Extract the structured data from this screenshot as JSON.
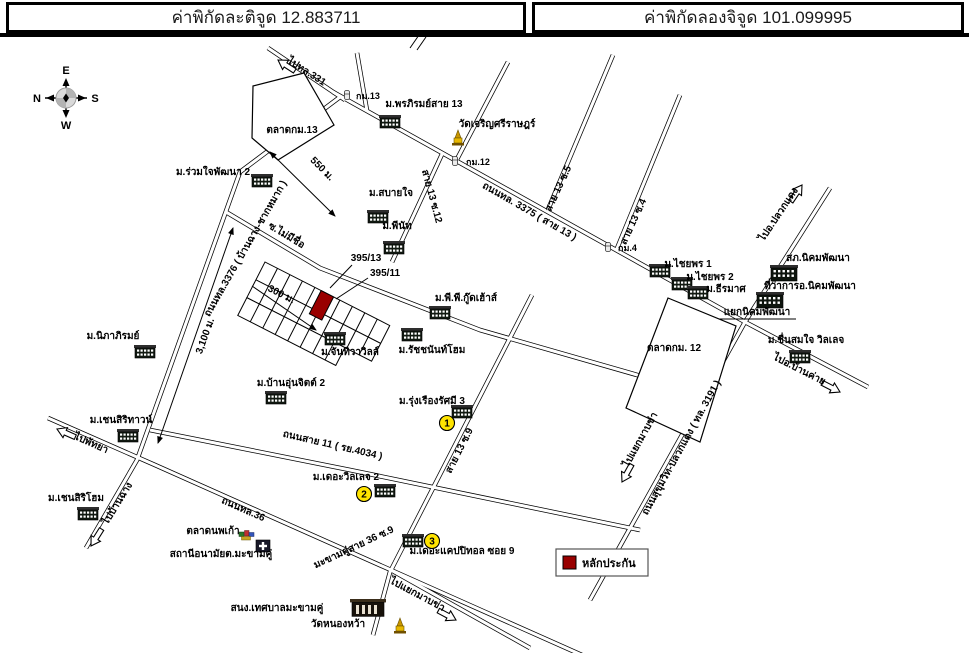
{
  "header": {
    "latitude": "ค่าพิกัดละติจูด 12.883711",
    "longitude": "ค่าพิกัดลองจิจูด 101.099995"
  },
  "compass": {
    "top": "E",
    "left": "N",
    "right": "S",
    "bottom": "W"
  },
  "legend": {
    "label": "หลักประกัน",
    "marker_color": "#990000"
  },
  "plot": {
    "number_top": "395/13",
    "number_bottom": "395/11"
  },
  "badges": {
    "b1": "1",
    "b2": "2",
    "b3": "3"
  },
  "distances": {
    "d550": "550 ม.",
    "d300": "300 ม.",
    "d3100": "3,100 ม."
  },
  "markers": {
    "km13": "กม.13",
    "km12": "กม.12",
    "km4": "กม.4"
  },
  "labels": {
    "go331": "ไปทล.331",
    "taladkm13": "ตลาดกม.13",
    "ruamjai": "ม.ร่วมใจพัฒนา 2",
    "phonphirom": "ม.พรภิรมย์สาย 13",
    "watcharoen": "วัดเจริญศรีราษฎร์",
    "sabaijai": "ม.สบายใจ",
    "peenut": "ม.พีนัท",
    "rd3375": "ถนนทล. 3375 ( สาย 13 )",
    "s13s12": "สาย 13 ซ.12",
    "s13s5": "สาย 13 ซ.5",
    "s13s4": "สาย 13 ซ.4",
    "gopluak": "ไปอ.ปลวกแดง",
    "police": "สภ.นิคมพัฒนา",
    "chaiya1": "ม.ไชยพร 1",
    "chaiya2": "ม.ไชยพร 2",
    "theeramat": "ม.ธีรมาศ",
    "amphoe": "ที่ว่าการอ.นิคมพัฒนา",
    "yaeknikhom": "แยกนิคมพัฒนา",
    "chuensomjai": "ม.ชื่นสมใจ วิลเลจ",
    "taladkm12": "ตลาดกม. 12",
    "gobankhai": "ไปอ.บ้านค่าย",
    "rdsukhumvit": "ถนนสุขุมวิท-ปลวกแดง ( ทล. 3191 )",
    "gomabkha1": "ไปแยกมาบข่า",
    "soinoname": "ซ.ไม่มีชื่อ",
    "rd3376": "ถนนทล.3376 ( บ้านฉาง-ชากหมาก )",
    "nipaphirom": "ม.นิภาภิรมย์",
    "janthiwa": "ม.จันทิวาวิลล์",
    "ratchanan": "ม.รัชชนันท์โฮม",
    "ppgood": "ม.พี.พี.กู๊ดเฮ้าส์",
    "baanunjit": "ม.บ้านอุ่นจิตต์ 2",
    "rdsai11": "ถนนสาย 11 ( รย.4034 )",
    "rungruang": "ม.รุ่งเรืองรัศมี 3",
    "s13s9": "สาย 13 ซ.9",
    "village2": "ม.เดอะวิลเลจ 2",
    "makhamkhu": "มะขามคู่สาย 36 ซ.9",
    "capitol": "ม.เดอะแคปปิทอล ซอย 9",
    "rd36": "ถนนทล.36",
    "noppakao": "ตลาดนพเก้า",
    "anamai": "สถานีอนามัยต.มะขามคู่",
    "chensiritown": "ม.เชนสิริทาวน์",
    "gopattaya": "ไปพัทยา",
    "chensirihome": "ม.เชนสิริโฮม",
    "gobanchang": "ไปบ้านฉาง",
    "tessaban": "สนง.เทศบาลมะขามคู่",
    "watnongwa": "วัดหนองหว้า",
    "gomabkha2": "ไปแยกมาบข่า"
  }
}
